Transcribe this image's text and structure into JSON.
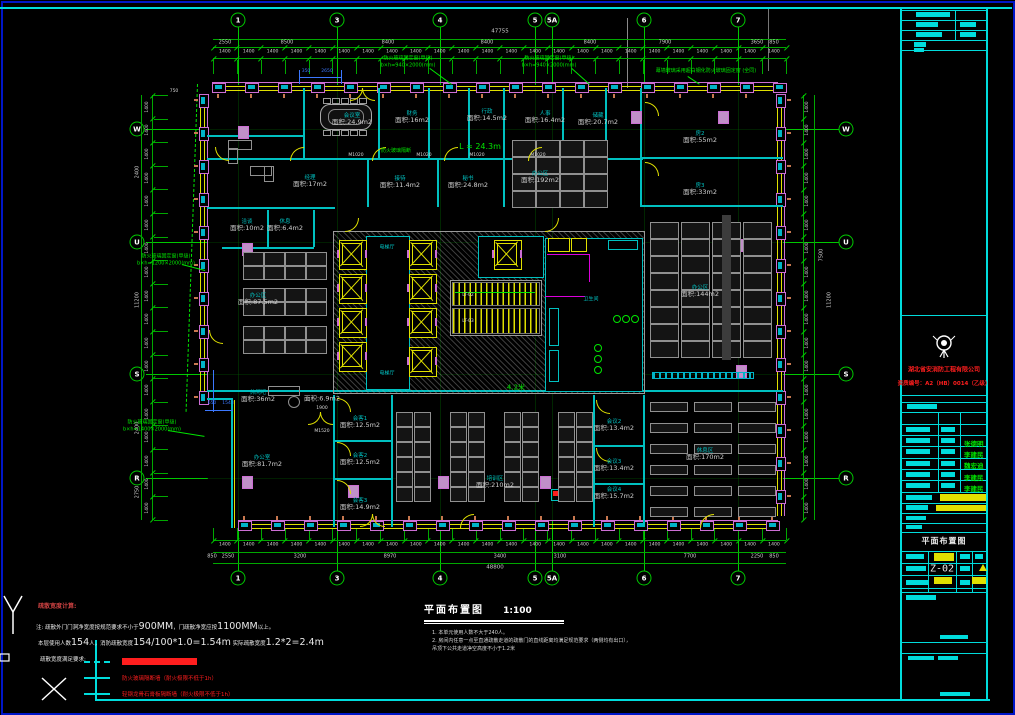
{
  "colors": {
    "frame_cyan": "#00dcdc",
    "border_blue": "#0016c8",
    "dim_green": "#00a800",
    "axis_green": "#00c800",
    "bright_green": "#00e600",
    "wall_cyan": "#00c0c0",
    "mullion_pink": "#cc6ed4",
    "glass_cyan": "#00b4c8",
    "yellow": "#e0e000",
    "red": "#ff1e1e",
    "desk_gray": "#909090",
    "text_gray": "#cfcfcf",
    "column_pink": "#c090c8",
    "blue_dim": "#3c78ff",
    "orange_tick": "#c87850",
    "magenta": "#dc00dc",
    "sign_green": "#00e600"
  },
  "plan": {
    "axes_x": [
      [
        "1",
        238
      ],
      [
        "3",
        337
      ],
      [
        "4",
        440
      ],
      [
        "5",
        535
      ],
      [
        "5A",
        552
      ],
      [
        "6",
        644
      ],
      [
        "7",
        738
      ]
    ],
    "axes_y": [
      [
        "W",
        129
      ],
      [
        "U",
        242
      ],
      [
        "S",
        374
      ],
      [
        "R",
        478
      ]
    ],
    "top_dims": {
      "total": "47755",
      "unit": "1400",
      "segs": [
        [
          "2550",
          225
        ],
        [
          "8500",
          287
        ],
        [
          "8400",
          388
        ],
        [
          "8400",
          487
        ],
        [
          "8400",
          590
        ],
        [
          "7900",
          665
        ],
        [
          "3650",
          757
        ],
        [
          "850",
          774
        ]
      ]
    },
    "bottom_dims": {
      "total": "48800",
      "segs": [
        [
          "850",
          212
        ],
        [
          "2550",
          228
        ],
        [
          "3200",
          300
        ],
        [
          "8970",
          390
        ],
        [
          "3400",
          500
        ],
        [
          "3100",
          560
        ],
        [
          "7700",
          690
        ],
        [
          "2250",
          757
        ],
        [
          "850",
          774
        ]
      ]
    },
    "left_dims": [
      [
        "2400",
        172
      ],
      [
        "11200",
        300
      ],
      [
        "2400",
        428
      ],
      [
        "2750",
        492
      ]
    ],
    "right_dims": [
      [
        "7500",
        255
      ],
      [
        "11200",
        300
      ]
    ],
    "rooms": [
      [
        "会议室",
        "面积:24.9m2",
        352,
        120
      ],
      [
        "财务",
        "面积:16m2",
        412,
        118
      ],
      [
        "行政",
        "面积:14.5m2",
        487,
        116
      ],
      [
        "人事",
        "面积:16.4m2",
        545,
        118
      ],
      [
        "储藏",
        "面积:20.7m2",
        598,
        120
      ],
      [
        "房2",
        "面积:55m2",
        700,
        138
      ],
      [
        "房3",
        "面积:33m2",
        700,
        190
      ],
      [
        "经理",
        "面积:17m2",
        310,
        182
      ],
      [
        "接待",
        "面积:11.4m2",
        400,
        183
      ],
      [
        "秘书",
        "面积:24.8m2",
        468,
        183
      ],
      [
        "办公区",
        "面积:192m2",
        540,
        178
      ],
      [
        "洽谈",
        "面积:10m2",
        247,
        226
      ],
      [
        "休息",
        "面积:6.4m2",
        285,
        226
      ],
      [
        "办公区",
        "面积:87.5m2",
        258,
        300
      ],
      [
        "办公区",
        "面积:144m2",
        700,
        292
      ],
      [
        "休闲吧",
        "面积:36m2",
        258,
        397
      ],
      [
        "",
        "面积:6.9m2",
        322,
        399
      ],
      [
        "办公室",
        "面积:81.7m2",
        262,
        462
      ],
      [
        "会客1",
        "面积:12.5m2",
        360,
        423
      ],
      [
        "会客2",
        "面积:12.5m2",
        360,
        460
      ],
      [
        "会客3",
        "面积:14.9m2",
        360,
        505
      ],
      [
        "培训区",
        "面积:210m2",
        495,
        483
      ],
      [
        "会议2",
        "面积:13.4m2",
        614,
        426
      ],
      [
        "会议3",
        "面积:13.4m2",
        614,
        466
      ],
      [
        "会议4",
        "面积:15.7m2",
        614,
        494
      ],
      [
        "休息区",
        "面积:170m2",
        705,
        455
      ]
    ],
    "core_labels": [
      [
        "电梯厅",
        387,
        248
      ],
      [
        "电梯厅",
        387,
        374
      ],
      [
        "卫生间",
        591,
        300
      ]
    ],
    "white_tags": [
      [
        "M1020",
        356,
        156
      ],
      [
        "M1020",
        424,
        156
      ],
      [
        "M1020",
        477,
        156
      ],
      [
        "M1020",
        538,
        156
      ],
      [
        "M1520",
        322,
        432
      ],
      [
        "1900",
        322,
        409
      ],
      [
        "LT-02",
        468,
        296
      ],
      [
        "LT-03",
        468,
        322
      ],
      [
        "750",
        174,
        92
      ]
    ],
    "green_notes": [
      {
        "lines": [
          "防火玻璃固定窗(甲级)",
          "b×h=940×2000(mm)"
        ],
        "x": 408,
        "y": 62,
        "s": 5
      },
      {
        "lines": [
          "防火玻璃固定窗(甲级)",
          "b×h=940×2000(mm)"
        ],
        "x": 549,
        "y": 62,
        "s": 5
      },
      {
        "lines": [
          "幕墙玻璃采用超白钢化防火玻璃固定窗 (全同)"
        ],
        "x": 706,
        "y": 71,
        "s": 5
      },
      {
        "lines": [
          "防火玻璃固定窗(甲级)",
          "b×h=1200×2000(mm)"
        ],
        "x": 166,
        "y": 260,
        "s": 5
      },
      {
        "lines": [
          "防火玻璃固定窗(甲级)",
          "b×h=1400×2000(mm)"
        ],
        "x": 152,
        "y": 426,
        "s": 5
      },
      {
        "lines": [
          "L = 24.3m"
        ],
        "x": 480,
        "y": 147,
        "s": 8
      },
      {
        "lines": [
          "4.2米"
        ],
        "x": 516,
        "y": 388,
        "s": 7
      },
      {
        "lines": [
          "防火玻璃隔断"
        ],
        "x": 396,
        "y": 151,
        "s": 5
      }
    ],
    "blue_dims": {
      "t1": "350",
      "t2": "2650",
      "t3": "650",
      "t4": "1543"
    },
    "walls_h": [
      [
        207,
        135,
        96
      ],
      [
        207,
        158,
        436
      ],
      [
        207,
        207,
        128
      ],
      [
        640,
        157,
        143
      ],
      [
        640,
        205,
        143
      ],
      [
        207,
        390,
        576
      ],
      [
        222,
        247,
        92
      ],
      [
        333,
        440,
        60
      ],
      [
        333,
        478,
        60
      ],
      [
        593,
        445,
        50
      ],
      [
        593,
        483,
        50
      ]
    ],
    "walls_v": [
      [
        303,
        88,
        72
      ],
      [
        378,
        88,
        72
      ],
      [
        428,
        88,
        72
      ],
      [
        468,
        88,
        72
      ],
      [
        503,
        88,
        72
      ],
      [
        562,
        88,
        72
      ],
      [
        605,
        88,
        72
      ],
      [
        640,
        88,
        119
      ],
      [
        367,
        160,
        47
      ],
      [
        437,
        160,
        47
      ],
      [
        503,
        160,
        47
      ],
      [
        267,
        210,
        37
      ],
      [
        313,
        210,
        37
      ],
      [
        333,
        395,
        132
      ],
      [
        391,
        395,
        132
      ],
      [
        593,
        395,
        132
      ],
      [
        643,
        395,
        132
      ]
    ],
    "core": {
      "x": 333,
      "y": 231,
      "w": 310,
      "h": 161
    },
    "elevators": [
      [
        339,
        240
      ],
      [
        339,
        274
      ],
      [
        339,
        308
      ],
      [
        339,
        342
      ],
      [
        409,
        240
      ],
      [
        409,
        274
      ],
      [
        409,
        308
      ],
      [
        409,
        347
      ],
      [
        494,
        240
      ]
    ],
    "desk_groups": [
      [
        243,
        252,
        4,
        2,
        19,
        12,
        2,
        2
      ],
      [
        243,
        288,
        4,
        2,
        19,
        12,
        2,
        2
      ],
      [
        243,
        326,
        4,
        2,
        19,
        12,
        2,
        2
      ],
      [
        512,
        140,
        4,
        4,
        22,
        15,
        2,
        2
      ],
      [
        650,
        222,
        4,
        8,
        27,
        15,
        4,
        2
      ],
      [
        396,
        412,
        2,
        6,
        15,
        13,
        3,
        2
      ],
      [
        450,
        412,
        2,
        6,
        15,
        13,
        3,
        2
      ],
      [
        504,
        412,
        2,
        6,
        15,
        13,
        3,
        2
      ],
      [
        558,
        412,
        2,
        6,
        15,
        13,
        3,
        2
      ],
      [
        650,
        402,
        3,
        6,
        36,
        8,
        8,
        13
      ]
    ],
    "columns": [
      [
        238,
        126
      ],
      [
        242,
        243
      ],
      [
        242,
        476
      ],
      [
        348,
        485
      ],
      [
        438,
        476
      ],
      [
        540,
        476
      ],
      [
        631,
        111
      ],
      [
        718,
        111
      ],
      [
        736,
        239
      ],
      [
        736,
        365
      ]
    ],
    "doors": [
      [
        215,
        147,
        0
      ],
      [
        290,
        147,
        90
      ],
      [
        372,
        147,
        90
      ],
      [
        444,
        147,
        90
      ],
      [
        528,
        147,
        90
      ],
      [
        645,
        102,
        180
      ],
      [
        645,
        162,
        180
      ],
      [
        345,
        218,
        270
      ],
      [
        545,
        218,
        270
      ],
      [
        337,
        398,
        180
      ],
      [
        337,
        442,
        180
      ],
      [
        337,
        480,
        180
      ],
      [
        596,
        400,
        0
      ],
      [
        596,
        448,
        0
      ],
      [
        209,
        330,
        0
      ],
      [
        700,
        514,
        90
      ],
      [
        460,
        514,
        90
      ]
    ],
    "double_doors": [
      [
        350,
        88
      ],
      [
        308,
        412
      ],
      [
        360,
        514
      ]
    ],
    "facade": [
      [
        "h",
        212,
        778,
        83
      ],
      [
        "h",
        238,
        778,
        521
      ],
      [
        "v",
        776,
        94,
        516
      ],
      [
        "v",
        199,
        94,
        398
      ]
    ]
  },
  "legend": {
    "heading": "疏散宽度计算:",
    "line1": [
      [
        "注: 疏散外门门洞净宽度按规范要求不小于",
        "s"
      ],
      [
        "900MM",
        "b"
      ],
      [
        "，门疏散净宽应按",
        "s"
      ],
      [
        "1100MM",
        "b"
      ],
      [
        "以上。",
        "s"
      ]
    ],
    "line2": [
      [
        "本层使用人数",
        "s"
      ],
      [
        "154",
        "b"
      ],
      [
        "人，消防疏散宽度",
        "s"
      ],
      [
        "154/100*1.0=1.54m",
        "b"
      ],
      [
        "  实际疏散宽度",
        "s"
      ],
      [
        "1.2*2=2.4m",
        "b"
      ]
    ],
    "line3": [
      [
        "疏散宽度满足要求:",
        "s"
      ]
    ],
    "items": [
      {
        "dash": true,
        "redbar": true,
        "text": ""
      },
      {
        "dash": false,
        "redbar": false,
        "text": "防火玻璃隔断墙（耐火极限不低于1h）"
      },
      {
        "dash": false,
        "redbar": false,
        "text": "轻钢龙骨石膏板隔断墙（耐火极限不低于1h）"
      }
    ]
  },
  "caption": {
    "title": "平面布置图",
    "scale": "1:100",
    "notes": [
      "1. 本单元使用人数不大于240人。",
      "2. 房间内任意一点至直通疏散走道的疏散门的直线距离均满足规范要求（两侧均有出口），",
      "    吊顶下公共走道净空高度不小于1.2米"
    ]
  },
  "titleblock": {
    "company": "湖北省安消防工程有限公司",
    "cert": "资质编号：A2（HB）0014（乙级）",
    "signatures": [
      "张德明",
      "李建民",
      "魏宏迪",
      "李建民",
      "李建民"
    ],
    "drawing_title": "平面布置图",
    "drawing_no": "Z-02"
  }
}
